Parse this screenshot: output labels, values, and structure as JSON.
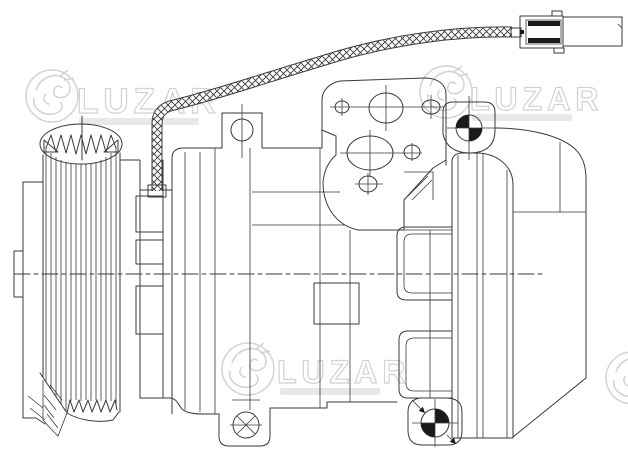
{
  "canvas": {
    "width": 628,
    "height": 462,
    "background": "#ffffff",
    "line_color": "#3a3a3a"
  },
  "watermark": {
    "brand": "LUZAR",
    "color": "#c4c4c4",
    "instances": [
      "top-left",
      "top-right",
      "bottom-center",
      "right-edge-partial"
    ]
  },
  "drawing": {
    "subject": "automotive A/C compressor side-view technical line drawing",
    "components": [
      "multi-rib belt pulley with grooved face",
      "pulley cutaway section with hatching",
      "clutch hub plates",
      "compressor housing cylinder",
      "rear cylinder head with oval ports",
      "two mounting ears",
      "bottom mounting lug with crossed bolt hole",
      "datum target mark top",
      "datum target mark bottom with leader arrows",
      "braided wire harness",
      "two-part electrical connector",
      "horizontal dash-dot center axis"
    ]
  }
}
